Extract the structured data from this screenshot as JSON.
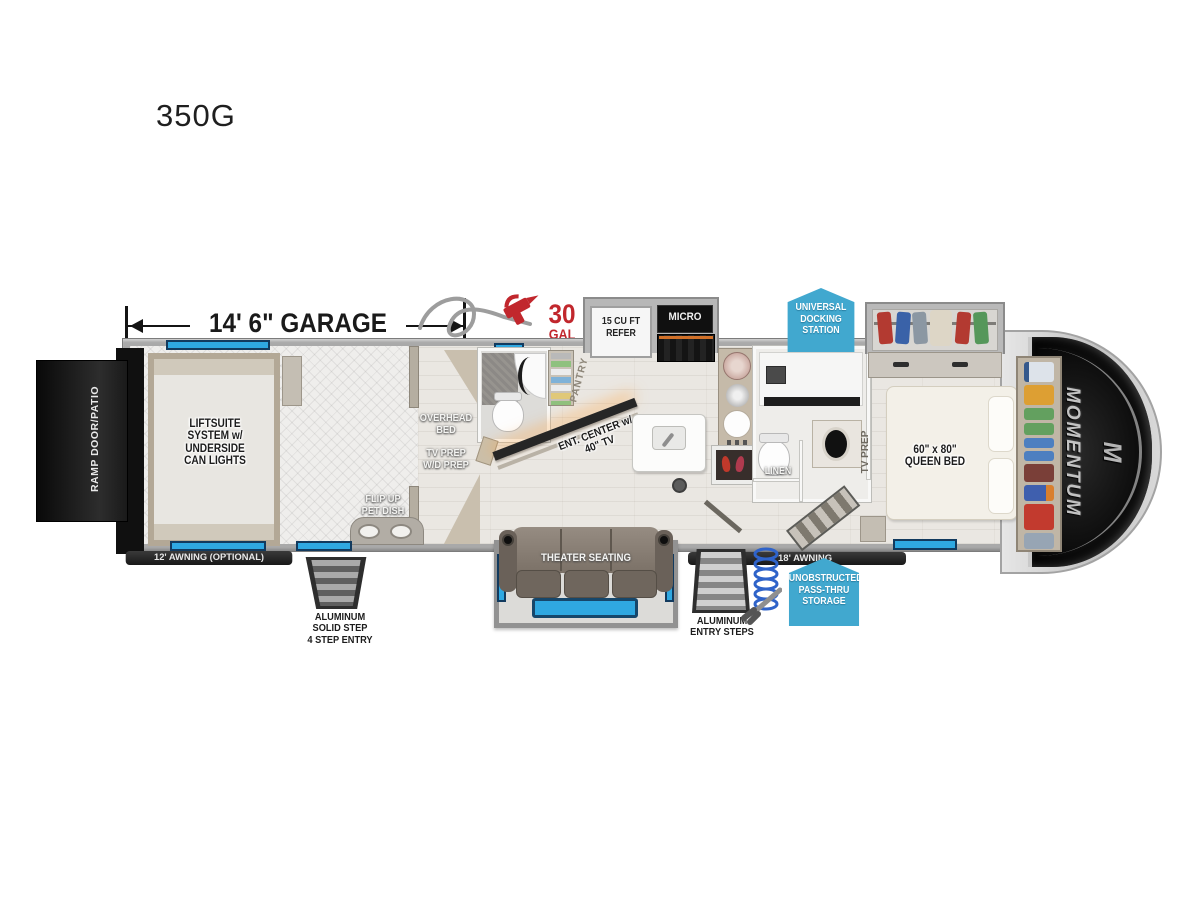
{
  "title": "350G",
  "dimension": {
    "garage": "14' 6\" GARAGE"
  },
  "fuel": {
    "qty": "30",
    "unit": "GAL"
  },
  "badges": {
    "docking": "UNIVERSAL\nDOCKING\nSTATION",
    "passthru": "UNOBSTRUCTED\nPASS-THRU\nSTORAGE"
  },
  "labels": {
    "ramp": "RAMP DOOR/PATIO",
    "liftsuite": "LIFTSUITE\nSYSTEM w/\nUNDERSIDE\nCAN LIGHTS",
    "awning_left": "12' AWNING (OPTIONAL)",
    "solid_step": "ALUMINUM\nSOLID STEP\n4 STEP ENTRY",
    "flip_up": "FLIP UP\nPET DISH",
    "overhead_bed": "OVERHEAD\nBED",
    "tv_wd_prep": "TV PREP\nW/D PREP",
    "pantry": "PANTRY",
    "ent_center": "ENT. CENTER w/\n40\" TV",
    "refer": "15 CU FT\nREFER",
    "micro": "MICRO",
    "linen": "LINEN",
    "tv_prep": "TV PREP",
    "queen_bed": "60\" x 80\"\nQUEEN BED",
    "theater": "THEATER SEATING",
    "awning_right": "18' AWNING",
    "entry_steps": "ALUMINUM\nENTRY STEPS",
    "momentum": "MOMENTUM",
    "momentum_mark": "M"
  },
  "colors": {
    "window_blue": "#2fa8e1",
    "badge_blue": "#41a8cf",
    "accent_red": "#c1272d",
    "ramp_black": "#161616",
    "wall_grey": "#a9a9a9"
  }
}
